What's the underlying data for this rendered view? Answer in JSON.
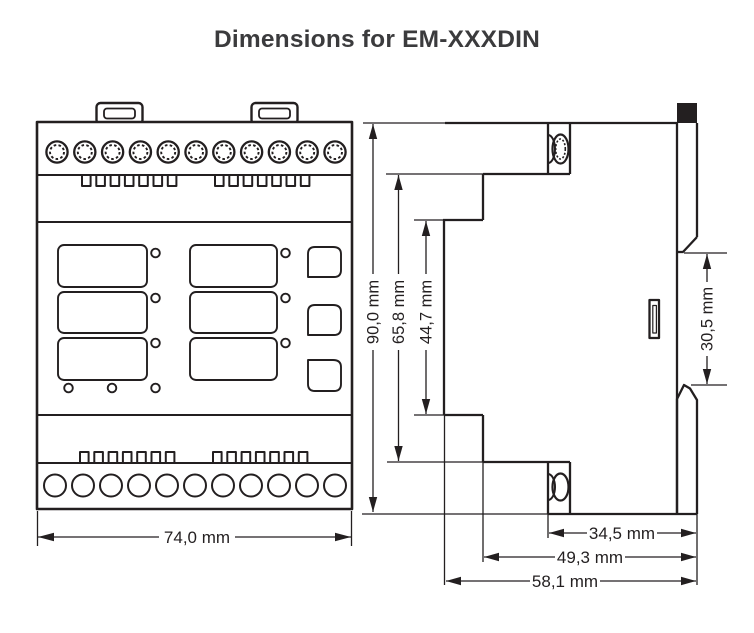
{
  "title": "Dimensions for EM-XXXDIN",
  "diagram": {
    "front_view": {
      "width_label": "74,0 mm"
    },
    "side_view": {
      "height_total_label": "90,0 mm",
      "height_terminal_label": "65,8 mm",
      "height_face_label": "44,7 mm",
      "din_rail_gap_label": "30,5 mm",
      "depth_rear_label": "34,5 mm",
      "depth_mid_label": "49,3 mm",
      "depth_total_label": "58,1 mm"
    },
    "colors": {
      "line": "#231f20",
      "title_text": "#3b3b3d",
      "background": "#ffffff"
    }
  }
}
